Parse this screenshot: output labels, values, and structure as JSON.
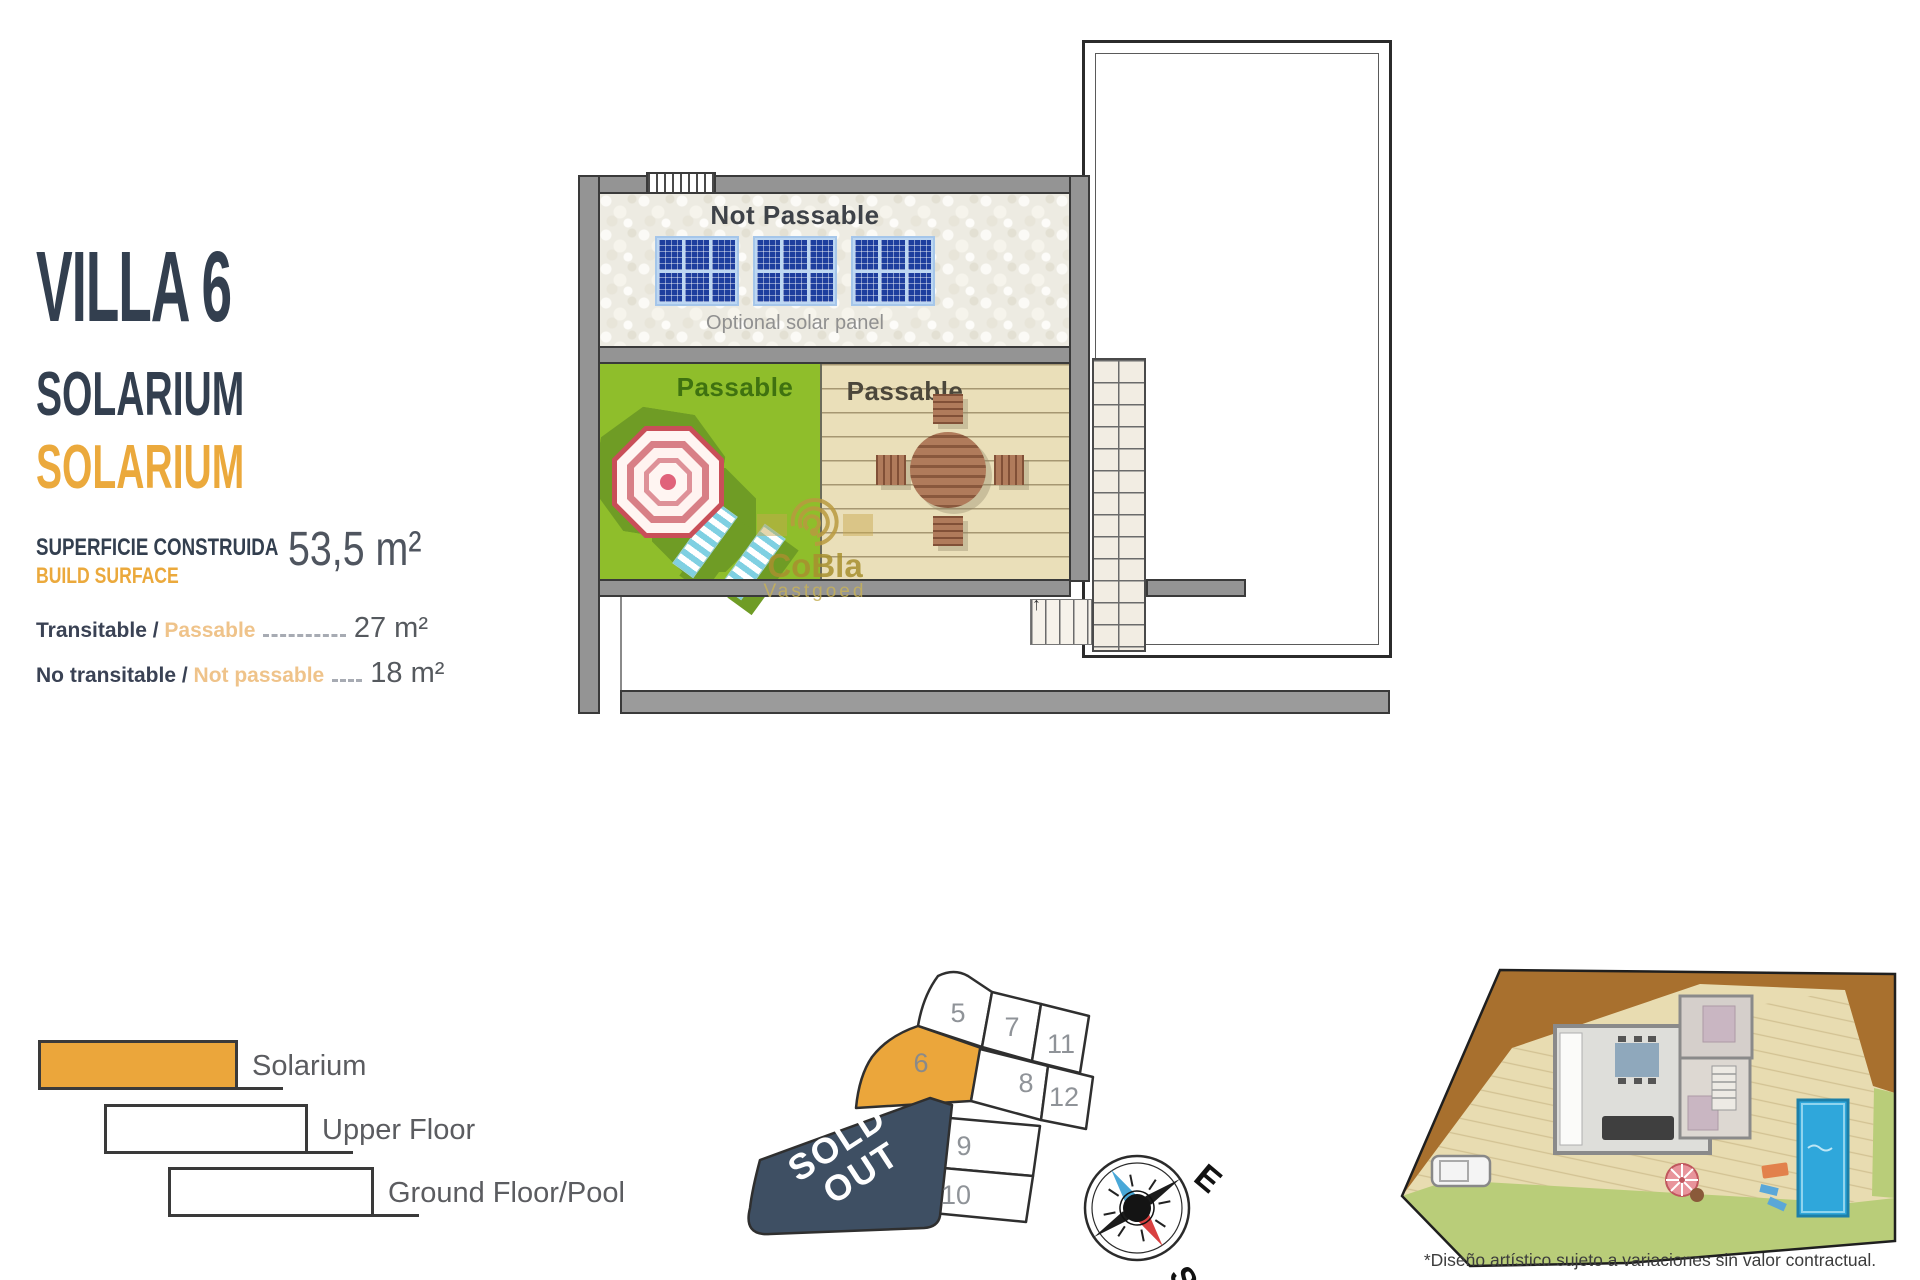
{
  "info_panel": {
    "title": "VILLA 6",
    "subtitle": "SOLARIUM",
    "subtitle_accent": "SOLARIUM",
    "build_surface_label_es": "SUPERFICIE CONSTRUIDA",
    "build_surface_label_en": "BUILD SURFACE",
    "build_surface_value": "53,5 m²",
    "metrics": [
      {
        "label_es": "Transitable / ",
        "label_en": "Passable",
        "value": "27 m²"
      },
      {
        "label_es": "No transitable / ",
        "label_en": "Not passable",
        "value": "18 m²"
      }
    ]
  },
  "floor_plan": {
    "not_passable_label": "Not Passable",
    "solar_caption": "Optional solar panel",
    "passable_green_label": "Passable",
    "passable_deck_label": "Passable",
    "stair_arrow": "↑"
  },
  "watermark": {
    "brand": "CoBla",
    "sub_brand": "Vastgoed"
  },
  "legend": {
    "items": [
      {
        "label": "Solarium"
      },
      {
        "label": "Upper Floor"
      },
      {
        "label": "Ground Floor/Pool"
      }
    ]
  },
  "plot_map": {
    "sold_out_line1": "SOLD",
    "sold_out_line2": "OUT",
    "highlighted_plot": "6",
    "plots": [
      {
        "id": "5"
      },
      {
        "id": "7"
      },
      {
        "id": "11"
      },
      {
        "id": "6"
      },
      {
        "id": "8"
      },
      {
        "id": "12"
      },
      {
        "id": "9"
      },
      {
        "id": "10"
      }
    ]
  },
  "compass": {
    "east_label": "E",
    "south_label": "S"
  },
  "site_plan": {
    "footnote": "*Diseño artístico sujeto a variaciones sin valor contractual."
  },
  "colors": {
    "navy": "#333F4F",
    "accent_orange": "#EBA93C",
    "plot_orange": "#EBA63B",
    "sold_out_navy": "#3E4F63",
    "plan_green": "#8FBE2B",
    "deck_tan": "#EADFB9",
    "solar_blue": "#1E3E9E",
    "wall_gray": "#949494",
    "pool_blue": "#2FA7DB"
  }
}
